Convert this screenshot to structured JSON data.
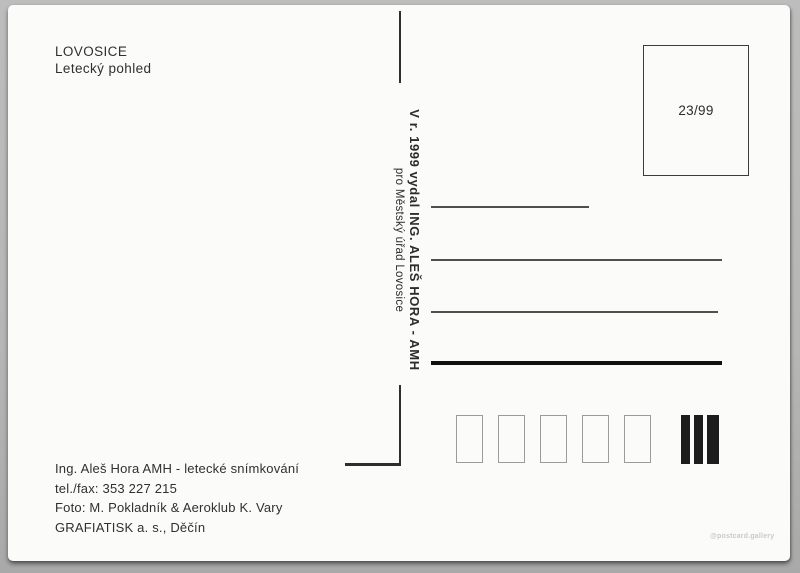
{
  "postcard": {
    "title": "LOVOSICE",
    "subtitle": "Letecký pohled",
    "publisher": {
      "line_bold": "V r. 1999 vydal ING. ALEŠ HORA - AMH",
      "line_small": "pro Městský úřad Lovosice"
    },
    "stamp_box": {
      "label": "23/99"
    },
    "credits": [
      "Ing. Aleš Hora AMH - letecké snímkování",
      "tel./fax: 353 227 215",
      "Foto: M. Pokladník & Aeroklub K. Vary",
      "GRAFIATISK a. s., Děčín"
    ],
    "watermark": "@postcard.gallery",
    "structure": {
      "address_lines_count": 4,
      "postal_code_boxes_count": 5,
      "code_bars_count": 3
    },
    "colors": {
      "background": "#b6b6b6",
      "card": "#fbfbfa",
      "ink": "#2e2e2e",
      "thin_rule": "#4f4f4f",
      "thick_rule": "#101010",
      "postal_box_border": "#9b9b9b",
      "code_bar": "#1d1d1d",
      "watermark": "#c9c9c9"
    }
  }
}
